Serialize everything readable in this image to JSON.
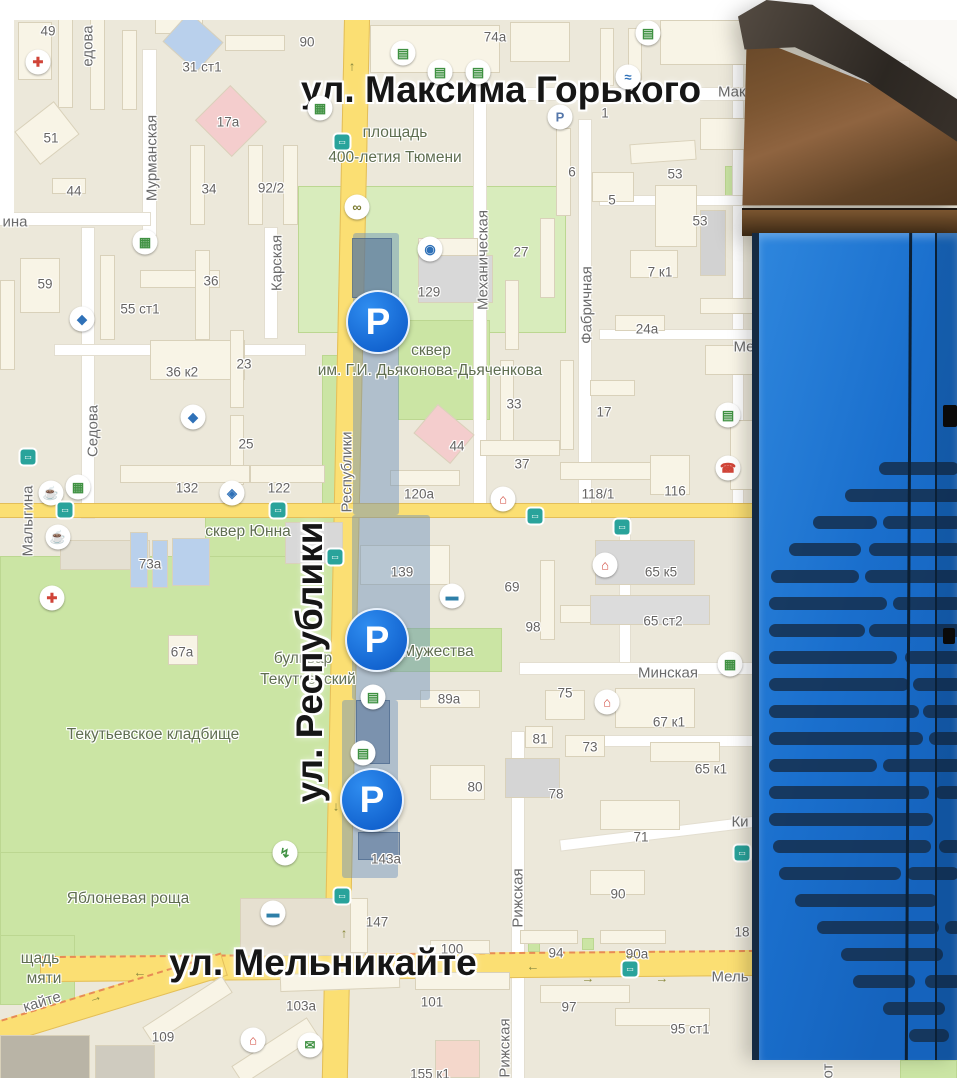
{
  "colors": {
    "land": "#ECE8DA",
    "building": "#F8F4E6",
    "park_green": "#CBE5A4",
    "road_yellow": "#FBDF73",
    "parking_zone": "rgba(104,142,186,0.45)",
    "parking_marker_blue": "#1774DC",
    "label_dark": "#161616",
    "label_grey": "#666463",
    "meter_body_blue": "#1C72CE",
    "meter_head_bronze": "#7B5531",
    "meter_stripe_navy": "#16304F"
  },
  "map": {
    "major_street_labels": [
      {
        "text": "ул. Максима Горького",
        "x": 501,
        "y": 90,
        "rotate": 0
      },
      {
        "text": "ул. Республики",
        "x": 310,
        "y": 662,
        "rotate": -90
      },
      {
        "text": "ул. Мельникайте",
        "x": 323,
        "y": 963,
        "rotate": 0
      }
    ],
    "street_labels": [
      {
        "text": "Мурманская",
        "x": 152,
        "y": 158,
        "rotate": -90
      },
      {
        "text": "едова",
        "x": 88,
        "y": 46,
        "rotate": -90
      },
      {
        "text": "Седова",
        "x": 93,
        "y": 431,
        "rotate": -90
      },
      {
        "text": "Карская",
        "x": 277,
        "y": 263,
        "rotate": -90
      },
      {
        "text": "Малыгина",
        "x": 28,
        "y": 521,
        "rotate": -90
      },
      {
        "text": "Механическая",
        "x": 483,
        "y": 260,
        "rotate": -90
      },
      {
        "text": "Фабричная",
        "x": 587,
        "y": 305,
        "rotate": -90
      },
      {
        "text": "Республики",
        "x": 347,
        "y": 472,
        "rotate": -90
      },
      {
        "text": "Рижская",
        "x": 518,
        "y": 898,
        "rotate": -90
      },
      {
        "text": "Рижская",
        "x": 505,
        "y": 1048,
        "rotate": -90
      },
      {
        "text": "Минская",
        "x": 668,
        "y": 673,
        "rotate": 0
      },
      {
        "text": "Мель",
        "x": 730,
        "y": 977,
        "rotate": 0
      },
      {
        "text": "кайте",
        "x": 42,
        "y": 1002,
        "rotate": -17
      },
      {
        "text": "ина",
        "x": 15,
        "y": 222,
        "rotate": 0
      },
      {
        "text": "Мако",
        "x": 736,
        "y": 92,
        "rotate": 0
      },
      {
        "text": "Ме",
        "x": 744,
        "y": 347,
        "rotate": 0
      },
      {
        "text": "Ки",
        "x": 740,
        "y": 822,
        "rotate": 0
      },
      {
        "text": "от",
        "x": 828,
        "y": 1071,
        "rotate": -90
      }
    ],
    "place_labels": [
      {
        "text": "площадь",
        "x": 395,
        "y": 133
      },
      {
        "text": "400-летия Тюмени",
        "x": 395,
        "y": 158
      },
      {
        "text": "сквер",
        "x": 431,
        "y": 351
      },
      {
        "text": "им. Г.И. Дьяконова-Дьяченкова",
        "x": 430,
        "y": 371
      },
      {
        "text": "сквер Юнна",
        "x": 248,
        "y": 532
      },
      {
        "text": "бульвар",
        "x": 303,
        "y": 659
      },
      {
        "text": "Текутьевский",
        "x": 308,
        "y": 680
      },
      {
        "text": "Мужества",
        "x": 438,
        "y": 652
      },
      {
        "text": "Текутьевское кладбище",
        "x": 153,
        "y": 735
      },
      {
        "text": "Яблоневая роща",
        "x": 128,
        "y": 899
      },
      {
        "text": "щадь",
        "x": 40,
        "y": 959
      },
      {
        "text": "мяти",
        "x": 44,
        "y": 979
      }
    ],
    "building_numbers": [
      {
        "t": "49",
        "x": 48,
        "y": 31
      },
      {
        "t": "90",
        "x": 307,
        "y": 42
      },
      {
        "t": "74а",
        "x": 495,
        "y": 37
      },
      {
        "t": "31 ст1",
        "x": 202,
        "y": 67
      },
      {
        "t": "1",
        "x": 605,
        "y": 113
      },
      {
        "t": "17а",
        "x": 228,
        "y": 122
      },
      {
        "t": "51",
        "x": 51,
        "y": 138
      },
      {
        "t": "44",
        "x": 74,
        "y": 191
      },
      {
        "t": "34",
        "x": 209,
        "y": 189
      },
      {
        "t": "92/2",
        "x": 271,
        "y": 188
      },
      {
        "t": "6",
        "x": 572,
        "y": 172
      },
      {
        "t": "53",
        "x": 675,
        "y": 174
      },
      {
        "t": "5",
        "x": 612,
        "y": 200
      },
      {
        "t": "53",
        "x": 700,
        "y": 221
      },
      {
        "t": "27",
        "x": 521,
        "y": 252
      },
      {
        "t": "7 к1",
        "x": 660,
        "y": 272
      },
      {
        "t": "24а",
        "x": 647,
        "y": 329
      },
      {
        "t": "59",
        "x": 45,
        "y": 284
      },
      {
        "t": "36",
        "x": 211,
        "y": 281
      },
      {
        "t": "55 ст1",
        "x": 140,
        "y": 309
      },
      {
        "t": "129",
        "x": 429,
        "y": 292
      },
      {
        "t": "36 к2",
        "x": 182,
        "y": 372
      },
      {
        "t": "23",
        "x": 244,
        "y": 364
      },
      {
        "t": "33",
        "x": 514,
        "y": 404
      },
      {
        "t": "17",
        "x": 604,
        "y": 412
      },
      {
        "t": "25",
        "x": 246,
        "y": 444
      },
      {
        "t": "44",
        "x": 457,
        "y": 446
      },
      {
        "t": "37",
        "x": 522,
        "y": 464
      },
      {
        "t": "132",
        "x": 187,
        "y": 488
      },
      {
        "t": "122",
        "x": 279,
        "y": 488
      },
      {
        "t": "120а",
        "x": 419,
        "y": 494
      },
      {
        "t": "118/1",
        "x": 598,
        "y": 494
      },
      {
        "t": "116",
        "x": 675,
        "y": 491
      },
      {
        "t": "73а",
        "x": 150,
        "y": 564
      },
      {
        "t": "139",
        "x": 402,
        "y": 572
      },
      {
        "t": "69",
        "x": 512,
        "y": 587
      },
      {
        "t": "65 к5",
        "x": 661,
        "y": 572
      },
      {
        "t": "65 ст2",
        "x": 663,
        "y": 621
      },
      {
        "t": "98",
        "x": 533,
        "y": 627
      },
      {
        "t": "67а",
        "x": 182,
        "y": 652
      },
      {
        "t": "75",
        "x": 565,
        "y": 693
      },
      {
        "t": "67 к1",
        "x": 669,
        "y": 722
      },
      {
        "t": "81",
        "x": 540,
        "y": 739
      },
      {
        "t": "73",
        "x": 590,
        "y": 747
      },
      {
        "t": "65 к1",
        "x": 711,
        "y": 769
      },
      {
        "t": "89а",
        "x": 449,
        "y": 699
      },
      {
        "t": "80",
        "x": 475,
        "y": 787
      },
      {
        "t": "78",
        "x": 556,
        "y": 794
      },
      {
        "t": "71",
        "x": 641,
        "y": 837
      },
      {
        "t": "90",
        "x": 618,
        "y": 894
      },
      {
        "t": "143а",
        "x": 386,
        "y": 859
      },
      {
        "t": "147",
        "x": 377,
        "y": 922
      },
      {
        "t": "100",
        "x": 452,
        "y": 949
      },
      {
        "t": "94",
        "x": 556,
        "y": 953
      },
      {
        "t": "90а",
        "x": 637,
        "y": 954
      },
      {
        "t": "18",
        "x": 742,
        "y": 932
      },
      {
        "t": "109",
        "x": 163,
        "y": 1037
      },
      {
        "t": "103а",
        "x": 301,
        "y": 1006
      },
      {
        "t": "101",
        "x": 432,
        "y": 1002
      },
      {
        "t": "97",
        "x": 569,
        "y": 1007
      },
      {
        "t": "95 ст1",
        "x": 690,
        "y": 1029
      },
      {
        "t": "155 к1",
        "x": 430,
        "y": 1074
      }
    ],
    "poi_icons": [
      {
        "name": "hospital-icon",
        "glyph": "✚",
        "color": "#d04438",
        "x": 38,
        "y": 62
      },
      {
        "name": "hospital-icon",
        "glyph": "✚",
        "color": "#d04438",
        "x": 52,
        "y": 598
      },
      {
        "name": "shop-house-icon",
        "glyph": "⌂",
        "color": "#d04438",
        "x": 503,
        "y": 499
      },
      {
        "name": "shop-house-icon",
        "glyph": "⌂",
        "color": "#d04438",
        "x": 605,
        "y": 565
      },
      {
        "name": "shop-house-icon",
        "glyph": "⌂",
        "color": "#d04438",
        "x": 607,
        "y": 702
      },
      {
        "name": "shop-house-icon",
        "glyph": "⌂",
        "color": "#d04438",
        "x": 253,
        "y": 1040
      },
      {
        "name": "phone-icon",
        "glyph": "☎",
        "color": "#d04438",
        "x": 728,
        "y": 468
      },
      {
        "name": "supermarket-icon",
        "glyph": "▦",
        "color": "#3f9142",
        "x": 320,
        "y": 108
      },
      {
        "name": "supermarket-icon",
        "glyph": "▦",
        "color": "#3f9142",
        "x": 145,
        "y": 242
      },
      {
        "name": "supermarket-icon",
        "glyph": "▦",
        "color": "#3f9142",
        "x": 78,
        "y": 487
      },
      {
        "name": "supermarket-icon",
        "glyph": "▦",
        "color": "#3f9142",
        "x": 730,
        "y": 664
      },
      {
        "name": "cafe-icon",
        "glyph": "☕",
        "color": "#a05a2c",
        "x": 51,
        "y": 493
      },
      {
        "name": "cafe-icon",
        "glyph": "☕",
        "color": "#a05a2c",
        "x": 58,
        "y": 537
      },
      {
        "name": "university-icon",
        "glyph": "◆",
        "color": "#2f71b8",
        "x": 82,
        "y": 319
      },
      {
        "name": "university-icon",
        "glyph": "◆",
        "color": "#2f71b8",
        "x": 193,
        "y": 417
      },
      {
        "name": "museum-icon",
        "glyph": "◈",
        "color": "#2f71b8",
        "x": 232,
        "y": 493
      },
      {
        "name": "theatre-icon",
        "glyph": "◉",
        "color": "#2f71b8",
        "x": 430,
        "y": 249
      },
      {
        "name": "hotel-icon",
        "glyph": "▬",
        "color": "#2e7fa8",
        "x": 452,
        "y": 596
      },
      {
        "name": "hotel-icon",
        "glyph": "▬",
        "color": "#2e7fa8",
        "x": 273,
        "y": 913
      },
      {
        "name": "ev-charge-icon",
        "glyph": "↯",
        "color": "#3f9142",
        "x": 285,
        "y": 853
      },
      {
        "name": "fountain-icon",
        "glyph": "≈",
        "color": "#2f71b8",
        "x": 628,
        "y": 77
      },
      {
        "name": "kiosk-icon",
        "glyph": "▤",
        "color": "#3f9142",
        "x": 403,
        "y": 53
      },
      {
        "name": "kiosk-icon",
        "glyph": "▤",
        "color": "#3f9142",
        "x": 440,
        "y": 72
      },
      {
        "name": "kiosk-icon",
        "glyph": "▤",
        "color": "#3f9142",
        "x": 478,
        "y": 72
      },
      {
        "name": "kiosk-icon",
        "glyph": "▤",
        "color": "#3f9142",
        "x": 648,
        "y": 33
      },
      {
        "name": "kiosk-icon",
        "glyph": "▤",
        "color": "#3f9142",
        "x": 373,
        "y": 697
      },
      {
        "name": "kiosk-icon",
        "glyph": "▤",
        "color": "#3f9142",
        "x": 363,
        "y": 753
      },
      {
        "name": "kiosk-icon",
        "glyph": "▤",
        "color": "#3f9142",
        "x": 728,
        "y": 415
      },
      {
        "name": "mail-icon",
        "glyph": "✉",
        "color": "#3f9142",
        "x": 310,
        "y": 1045
      },
      {
        "name": "bike-icon",
        "glyph": "∞",
        "color": "#7a7a30",
        "x": 357,
        "y": 207
      },
      {
        "name": "parking-sign-icon",
        "glyph": "P",
        "color": "#5577aa",
        "x": 560,
        "y": 117
      }
    ],
    "bus_stops": [
      {
        "x": 342,
        "y": 142
      },
      {
        "x": 28,
        "y": 457
      },
      {
        "x": 65,
        "y": 510
      },
      {
        "x": 278,
        "y": 510
      },
      {
        "x": 535,
        "y": 516
      },
      {
        "x": 622,
        "y": 527
      },
      {
        "x": 335,
        "y": 557
      },
      {
        "x": 342,
        "y": 896
      },
      {
        "x": 630,
        "y": 969
      },
      {
        "x": 742,
        "y": 853
      }
    ],
    "road_arrows": [
      {
        "g": "↑",
        "x": 352,
        "y": 66,
        "r": 0
      },
      {
        "g": "↓",
        "x": 336,
        "y": 806,
        "r": 0
      },
      {
        "g": "↑",
        "x": 344,
        "y": 933,
        "r": 0
      },
      {
        "g": "←",
        "x": 533,
        "y": 966,
        "r": 0
      },
      {
        "g": "→",
        "x": 588,
        "y": 978,
        "r": 0
      },
      {
        "g": "←",
        "x": 630,
        "y": 954,
        "r": 0
      },
      {
        "g": "→",
        "x": 662,
        "y": 978,
        "r": 0
      },
      {
        "g": "←",
        "x": 140,
        "y": 972,
        "r": 0
      },
      {
        "g": "→",
        "x": 95,
        "y": 997,
        "r": -18
      }
    ],
    "parking_markers": [
      {
        "label": "P",
        "x": 378,
        "y": 322
      },
      {
        "label": "P",
        "x": 377,
        "y": 640
      },
      {
        "label": "P",
        "x": 372,
        "y": 800
      }
    ]
  },
  "photo": {
    "subject": "street parking pay station, bronze top and blue body with navy slot pattern"
  }
}
